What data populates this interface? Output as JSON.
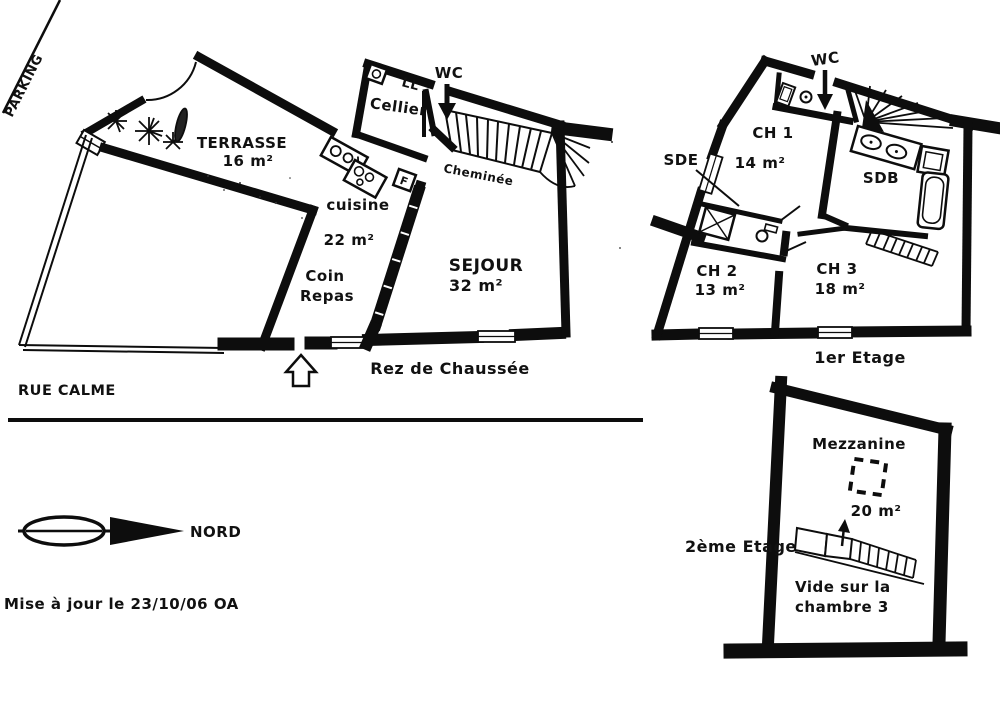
{
  "document": {
    "background": "#ffffff",
    "ink": "#111111"
  },
  "ground_floor": {
    "floor_label": "Rez de Chaussée",
    "street_label": "RUE CALME",
    "parking_label": "PARKING",
    "terrace": {
      "name": "TERRASSE",
      "area": "16 m²"
    },
    "wc": {
      "name": "WC"
    },
    "cellier": {
      "name": "Cellier",
      "washer_label": "LL"
    },
    "kitchen": {
      "name": "cuisine",
      "area": "22 m²",
      "fridge_label": "F"
    },
    "dining": {
      "line1": "Coin",
      "line2": "Repas"
    },
    "living": {
      "name": "SEJOUR",
      "area": "32 m²"
    },
    "stairs_note": "Cheminée"
  },
  "first_floor": {
    "floor_label": "1er Etage",
    "wc": {
      "name": "WC"
    },
    "bedroom1": {
      "name": "CH 1",
      "area": "14 m²"
    },
    "bedroom2": {
      "name": "CH 2",
      "area": "13 m²"
    },
    "bedroom3": {
      "name": "CH 3",
      "area": "18 m²"
    },
    "shower_room": {
      "name": "SDE"
    },
    "bathroom": {
      "name": "SDB"
    }
  },
  "second_floor": {
    "floor_label": "2ème Etage",
    "mezzanine": {
      "name": "Mezzanine",
      "area": "20 m²"
    },
    "void": {
      "line1": "Vide sur la",
      "line2": "chambre 3"
    }
  },
  "compass": {
    "north_label": "NORD"
  },
  "footer": {
    "revision_note": "Mise à jour le 23/10/06 OA"
  },
  "symbols": {
    "entrance_arrow": "hollow-up-arrow",
    "wc_direction_arrow": "solid-down-arrow",
    "stair_direction_arrow": "up-arrow",
    "north_pointer": "ellipse-shaft-triangle",
    "plants": "starburst-shrubs",
    "skylight": "dashed-square"
  }
}
